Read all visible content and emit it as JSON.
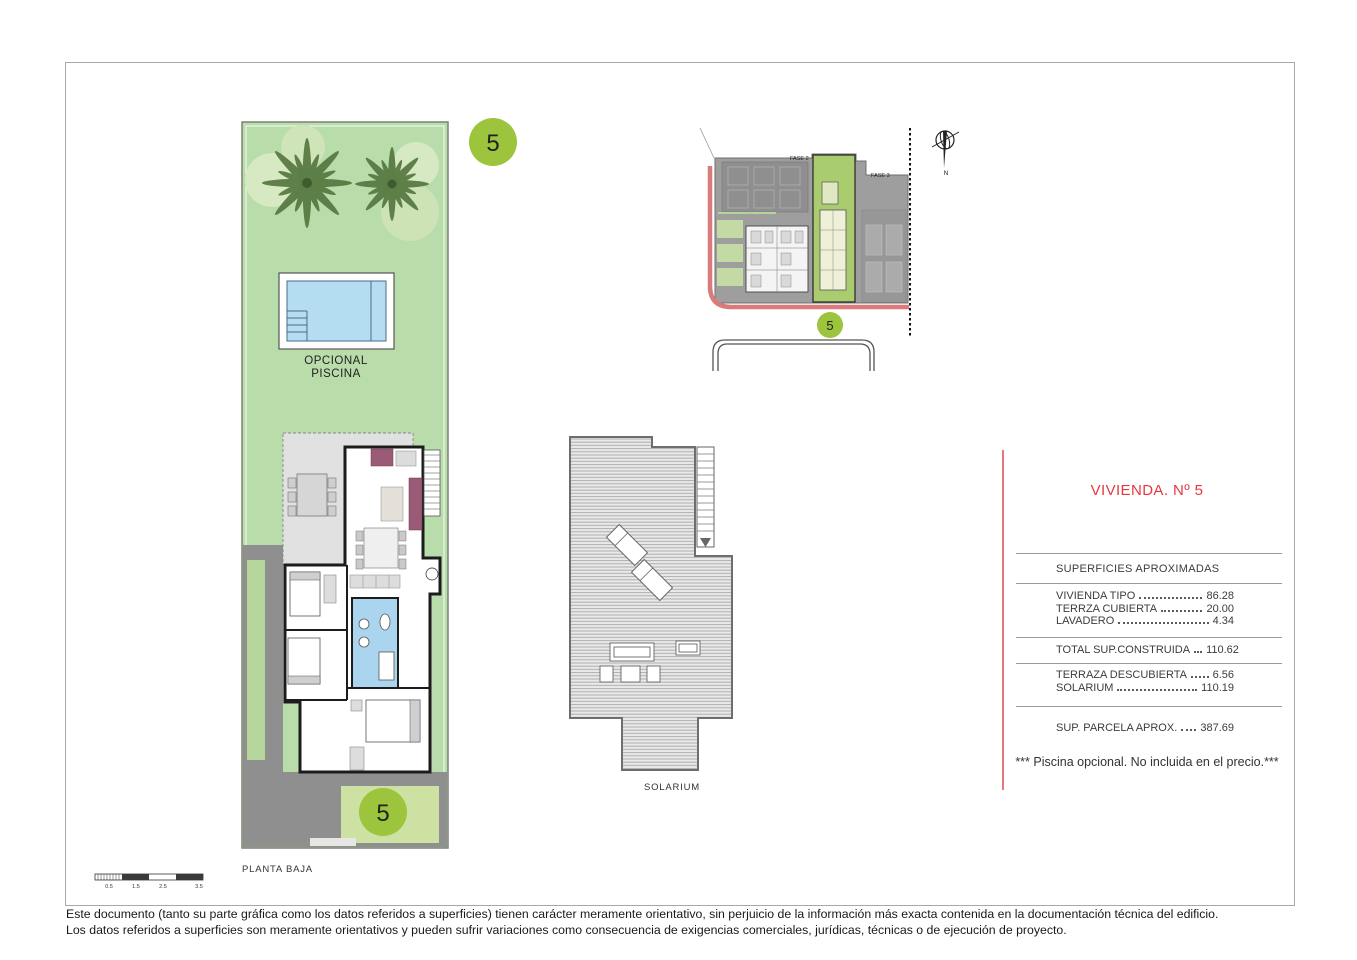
{
  "badge_number": "5",
  "ground_plan": {
    "pool_label_line1": "OPCIONAL",
    "pool_label_line2": "PISCINA",
    "floor_label": "PLANTA BAJA",
    "scale_ticks": [
      "0.5",
      "1.5",
      "2.5",
      "3.5"
    ]
  },
  "site_plan": {
    "fase2_label": "FASE 2",
    "fase3_label": "FASE 3",
    "north_label": "N"
  },
  "solarium": {
    "label": "SOLARIUM"
  },
  "panel": {
    "title": "VIVIENDA. Nº 5",
    "header": "SUPERFICIES APROXIMADAS",
    "rows_a": [
      {
        "label": "VIVIENDA TIPO",
        "value": "86.28"
      },
      {
        "label": "TERRZA CUBIERTA",
        "value": "20.00"
      },
      {
        "label": "LAVADERO",
        "value": "4.34"
      }
    ],
    "row_total": {
      "label": "TOTAL SUP.CONSTRUIDA",
      "value": "110.62"
    },
    "rows_b": [
      {
        "label": "TERRAZA DESCUBIERTA",
        "value": "6.56"
      },
      {
        "label": "SOLARIUM",
        "value": "110.19"
      }
    ],
    "row_parcela": {
      "label": "SUP. PARCELA APROX.",
      "value": "387.69"
    },
    "note": "*** Piscina opcional. No incluida en el precio.***"
  },
  "footer": {
    "line1": "Este documento (tanto su parte gráfica como los datos referidos a superficies) tienen carácter meramente orientativo, sin perjuicio de la información más exacta contenida en la documentación técnica del edificio.",
    "line2": "Los datos referidos a superficies son meramente orientativos y pueden sufrir variaciones como consecuencia de exigencias comerciales, jurídicas, técnicas o de ejecución de proyecto."
  },
  "colors": {
    "accent_red": "#e5383f",
    "plot_green": "#b9dcab",
    "badge_green": "#9cc43d",
    "pool_blue": "#b5ddf2",
    "site_plot_green": "#a9cc6e",
    "road_red": "#d97b7b",
    "driveway_gray": "#8f8f8f"
  }
}
